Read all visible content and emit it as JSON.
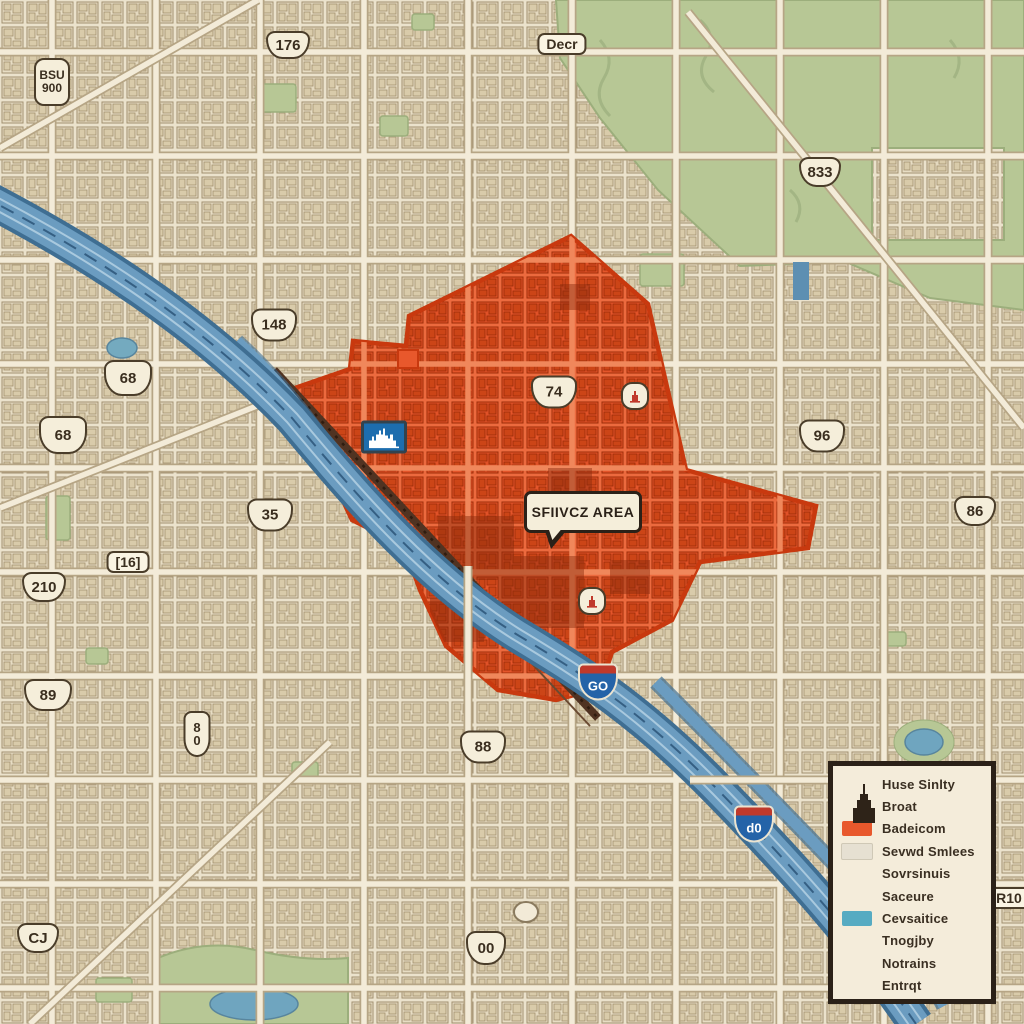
{
  "callout": {
    "label": "SFIIVCZ AREA"
  },
  "shields": [
    {
      "id": "bsu900",
      "type": "vertical-rect",
      "line1": "BSU",
      "line2": "900"
    },
    {
      "id": "s176",
      "type": "us-shield",
      "label": "176"
    },
    {
      "id": "decr",
      "type": "rect-label",
      "label": "Decr"
    },
    {
      "id": "s833",
      "type": "us-shield",
      "label": "833"
    },
    {
      "id": "s148",
      "type": "us-shield",
      "label": "148"
    },
    {
      "id": "s68a",
      "type": "us-shield",
      "label": "68"
    },
    {
      "id": "s68b",
      "type": "us-shield",
      "label": "68"
    },
    {
      "id": "s74",
      "type": "us-shield",
      "label": "74"
    },
    {
      "id": "s35",
      "type": "us-shield",
      "label": "35"
    },
    {
      "id": "r16",
      "type": "rect-label",
      "label": "[16]"
    },
    {
      "id": "s210",
      "type": "us-shield",
      "label": "210"
    },
    {
      "id": "s96",
      "type": "us-shield",
      "label": "96"
    },
    {
      "id": "s86",
      "type": "us-shield",
      "label": "86"
    },
    {
      "id": "s89",
      "type": "us-shield",
      "label": "89"
    },
    {
      "id": "s80",
      "type": "vertical-shield",
      "line1": "8",
      "line2": "0"
    },
    {
      "id": "s88",
      "type": "us-shield",
      "label": "88"
    },
    {
      "id": "i60",
      "type": "interstate",
      "label": "GO"
    },
    {
      "id": "i40",
      "type": "interstate",
      "label": "d0"
    },
    {
      "id": "s00",
      "type": "us-shield",
      "label": "00"
    },
    {
      "id": "sCJ",
      "type": "us-shield",
      "label": "CJ"
    },
    {
      "id": "r10",
      "type": "rect-label",
      "label": "R10"
    }
  ],
  "legend": {
    "items": [
      {
        "label": "Huse Sinlty",
        "swatch": "building-icon"
      },
      {
        "label": "Broat",
        "swatch": "none"
      },
      {
        "label": "Badeicom",
        "swatch": "orange"
      },
      {
        "label": "Sevwd Smlees",
        "swatch": "pale"
      },
      {
        "label": "Sovrsinuis",
        "swatch": "none"
      },
      {
        "label": "Saceure",
        "swatch": "none"
      },
      {
        "label": "Cevsaitice",
        "swatch": "teal"
      },
      {
        "label": "Tnogjby",
        "swatch": "none"
      },
      {
        "label": "Notrains",
        "swatch": "none"
      },
      {
        "label": "Entrqt",
        "swatch": "none"
      }
    ]
  },
  "icons": {
    "legend_building": "building-icon",
    "downtown_sign": "city-skyline-icon",
    "poi_badge": "monument-icon"
  },
  "colors": {
    "service_area": "#E8582C",
    "service_area_border": "#C8390F",
    "water": "#6B9CC0",
    "park": "#B7C795",
    "paper": "#ECE3CE",
    "legend_bg": "#F4ECDA",
    "ink": "#2B2118",
    "interstate_blue": "#2463A8",
    "interstate_red": "#C0392B",
    "downtown_sign_blue": "#1D6DAE",
    "swatch_teal": "#56ABC2"
  }
}
